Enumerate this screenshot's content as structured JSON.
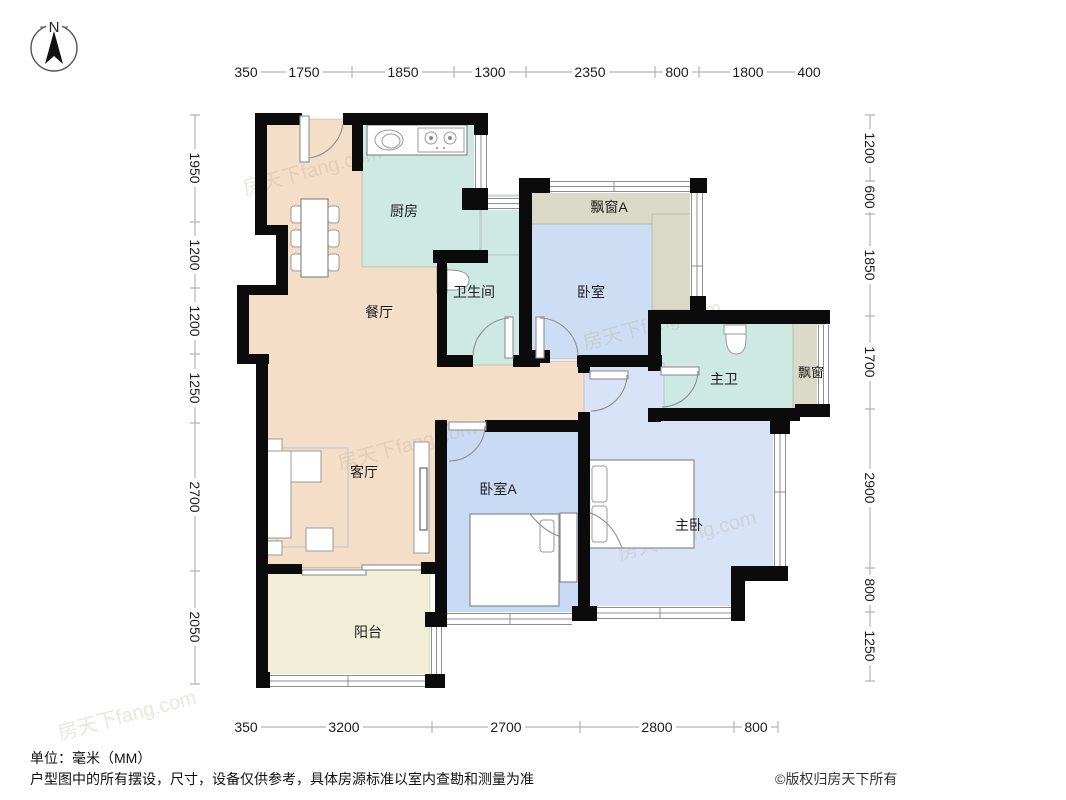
{
  "compass": {
    "label": "N"
  },
  "watermark": "房天下fang.com",
  "rooms": {
    "kitchen": "厨房",
    "dining": "餐厅",
    "bathroom": "卫生间",
    "bedroom": "卧室",
    "bay_a": "飘窗A",
    "master_bath": "主卫",
    "bay": "飘窗",
    "living": "客厅",
    "bedroom_a": "卧室A",
    "master": "主卧",
    "balcony": "阳台"
  },
  "dims": {
    "top": [
      "350",
      "1750",
      "1850",
      "1300",
      "2350",
      "800",
      "1800",
      "400"
    ],
    "left": [
      "1950",
      "1200",
      "1200",
      "1250",
      "2700",
      "2050"
    ],
    "right": [
      "1200",
      "600",
      "1850",
      "1700",
      "2900",
      "800",
      "1250"
    ],
    "bottom": [
      "350",
      "3200",
      "2700",
      "2800",
      "800"
    ]
  },
  "footer": {
    "unit_note": "单位：毫米（MM）",
    "disclaimer": "户型图中的所有摆设，尺寸，设备仅供参考，具体房源标准以室内查勘和测量为准",
    "copyright": "©版权归房天下所有"
  },
  "colors": {
    "wall": "#0b0b0b",
    "dining_living": "#f5dec8",
    "kitchen_bath": "#cde9e1",
    "bedroom": "#cddef4",
    "bedroom_a": "#c9dbf4",
    "master_bedroom": "#d8e3f7",
    "bay_window": "#dbd9c8",
    "balcony": "#f2efd8",
    "dimension_line": "#b3b3b3",
    "text": "#1c1c1c"
  }
}
